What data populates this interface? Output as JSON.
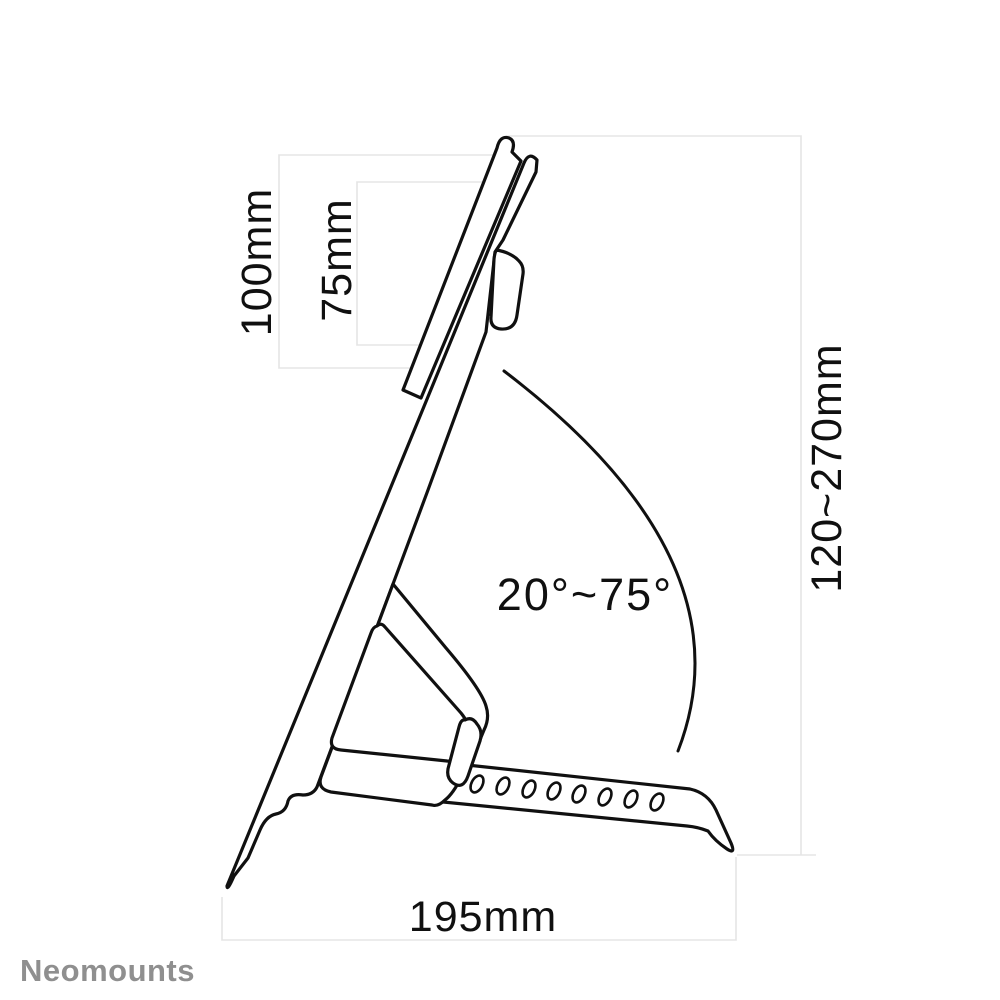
{
  "diagram": {
    "type": "product-dimension-line-drawing",
    "subject": "tilting display floor-stand side view",
    "labels": {
      "vesa_outer": "100mm",
      "vesa_inner": "75mm",
      "height_range": "120~270mm",
      "tilt_range": "20°~75°",
      "base_depth": "195mm"
    },
    "brand": {
      "name": "Neomounts",
      "color": "#8f8f8f"
    },
    "colors": {
      "line": "#101010",
      "dimension_line": "#e5e5e5",
      "background": "#ffffff"
    },
    "adjustment_hole_count": 8
  }
}
